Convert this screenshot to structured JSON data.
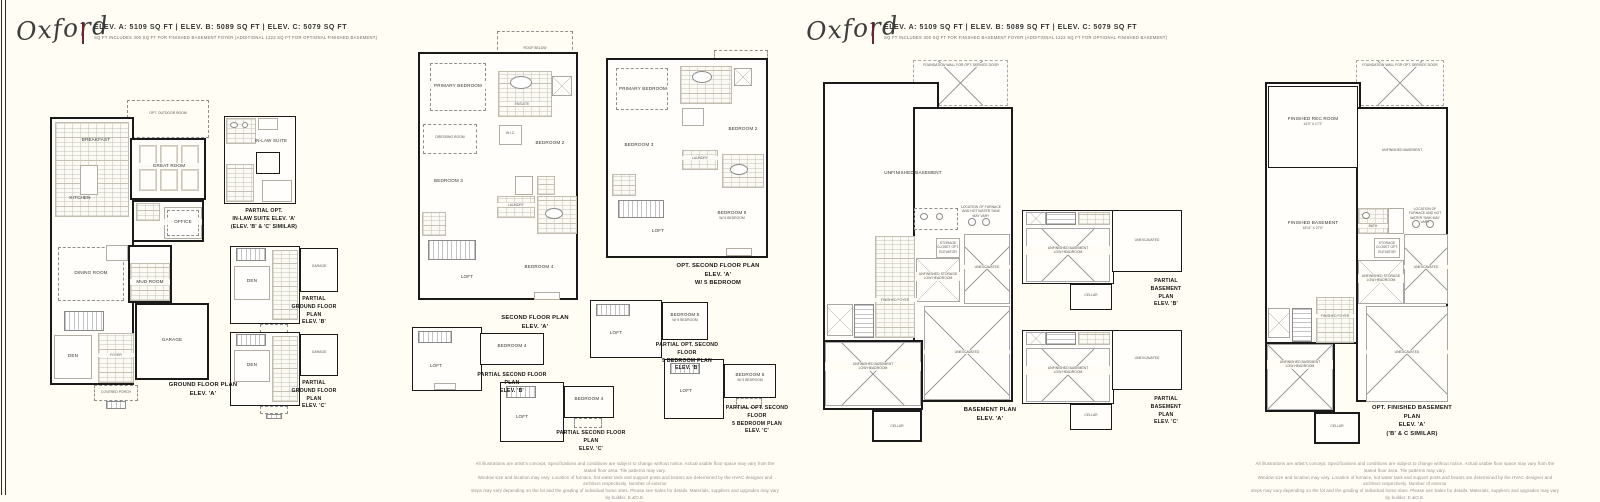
{
  "page": {
    "bg": "#fffdf4",
    "accent": "#6b2433"
  },
  "header": {
    "logo": "Oxford",
    "elev": "ELEV. A: 5109 SQ FT  |  ELEV. B: 5089 SQ FT  |  ELEV. C: 5079 SQ FT",
    "note": "SQ FT INCLUDES 300 SQ FT FOR FINISHED BASEMENT FOYER (ADDITIONAL 1222 SQ FT FOR OPTIONAL FINISHED BASEMENT)"
  },
  "captions": {
    "ground_a": [
      "GROUND FLOOR PLAN",
      "ELEV. 'A'"
    ],
    "in_law": [
      "PARTIAL OPT.",
      "IN-LAW SUITE ELEV. 'A'",
      "(ELEV. 'B' & 'C' SIMILAR)"
    ],
    "ground_b": [
      "PARTIAL",
      "GROUND FLOOR PLAN",
      "ELEV. 'B'"
    ],
    "ground_c": [
      "PARTIAL",
      "GROUND FLOOR PLAN",
      "ELEV. 'C'"
    ],
    "second_a": [
      "SECOND FLOOR PLAN",
      "ELEV. 'A'"
    ],
    "opt_second_a": [
      "OPT. SECOND FLOOR PLAN",
      "ELEV. 'A'",
      "W/ 5 BEDROOM"
    ],
    "partial_second_b": [
      "PARTIAL SECOND FLOOR PLAN",
      "ELEV. 'B'"
    ],
    "partial_opt_second_b": [
      "PARTIAL OPT. SECOND FLOOR",
      "5 BEDROOM PLAN",
      "ELEV. 'B'"
    ],
    "partial_second_c": [
      "PARTIAL SECOND FLOOR PLAN",
      "ELEV. 'C'"
    ],
    "partial_opt_second_c": [
      "PARTIAL OPT. SECOND FLOOR",
      "5 BEDROOM PLAN",
      "ELEV. 'C'"
    ],
    "basement_a": [
      "BASEMENT PLAN",
      "ELEV. 'A'"
    ],
    "basement_b": [
      "PARTIAL",
      "BASEMENT PLAN",
      "ELEV. 'B'"
    ],
    "basement_c": [
      "PARTIAL",
      "BASEMENT PLAN",
      "ELEV. 'C'"
    ],
    "opt_basement": [
      "OPT. FINISHED BASEMENT PLAN",
      "ELEV. 'A'",
      "('B' & C SIMILAR)"
    ]
  },
  "rooms": {
    "breakfast": "BREAKFAST",
    "kitchen": "KITCHEN",
    "great_room": "GREAT ROOM",
    "opt_outdoor": "OPT. OUTDOOR ROOM",
    "dining": "DINING ROOM",
    "office": "OFFICE",
    "mud": "MUD ROOM",
    "den": "DEN",
    "garage": "GARAGE",
    "foyer": "FOYER",
    "porch": "COVERED PORCH",
    "in_law": "IN-LAW SUITE",
    "bath": "BATH",
    "wic": "W.I.C.",
    "primary": "PRIMARY BEDROOM",
    "dressing": "DRESSING ROOM",
    "ensuite": "ENSUITE",
    "bed2": "BEDROOM 2",
    "bed3": "BEDROOM 3",
    "bed4": "BEDROOM 4",
    "bed5": "BEDROOM 5",
    "w5": "W/ 5 BEDROOM",
    "laundry": "LAUNDRY",
    "loft": "LOFT",
    "roof_below": "ROOF BELOW",
    "unfin": "UNFINISHED BASEMENT",
    "unex": "UNEXCAVATED",
    "fin_foyer": "FINISHED FOYER",
    "unfin_storage": "UNFINISHED STORAGE",
    "low_head": "LOW HEADROOM",
    "storage_closet": "STORAGE CLOSET OPT. ELEVATOR",
    "cellar": "CELLAR",
    "rec": "FINISHED REC ROOM",
    "rec_dim": "14'0\" x 17'2\"",
    "finb": "FINISHED BASEMENT",
    "finb_dim": "18'11\" x 27'0\"",
    "service": "FOUNDATION WALL FOR OPT. SERVICE DOOR",
    "furnace_note": "LOCATION OF FURNACE AND HOT WATER TANK MAY VARY",
    "up": "UP"
  },
  "disclaimer": {
    "line1": "All illustrations are artist's concept. Specifications and conditions are subject to change without notice. Actual usable floor space may vary from the stated floor area. Tile patterns may vary.",
    "line2": "Window size and location may vary. Location of furnace, hot water tank and support posts and beams are determined by the HVAC designer and architect respectively. Number of exterior",
    "line3": "steps may vary depending on the lot and the grading of individual home sites. Please see Sales for details. Materials, suppliers and upgrades may vary by builder. E.&O.E."
  }
}
